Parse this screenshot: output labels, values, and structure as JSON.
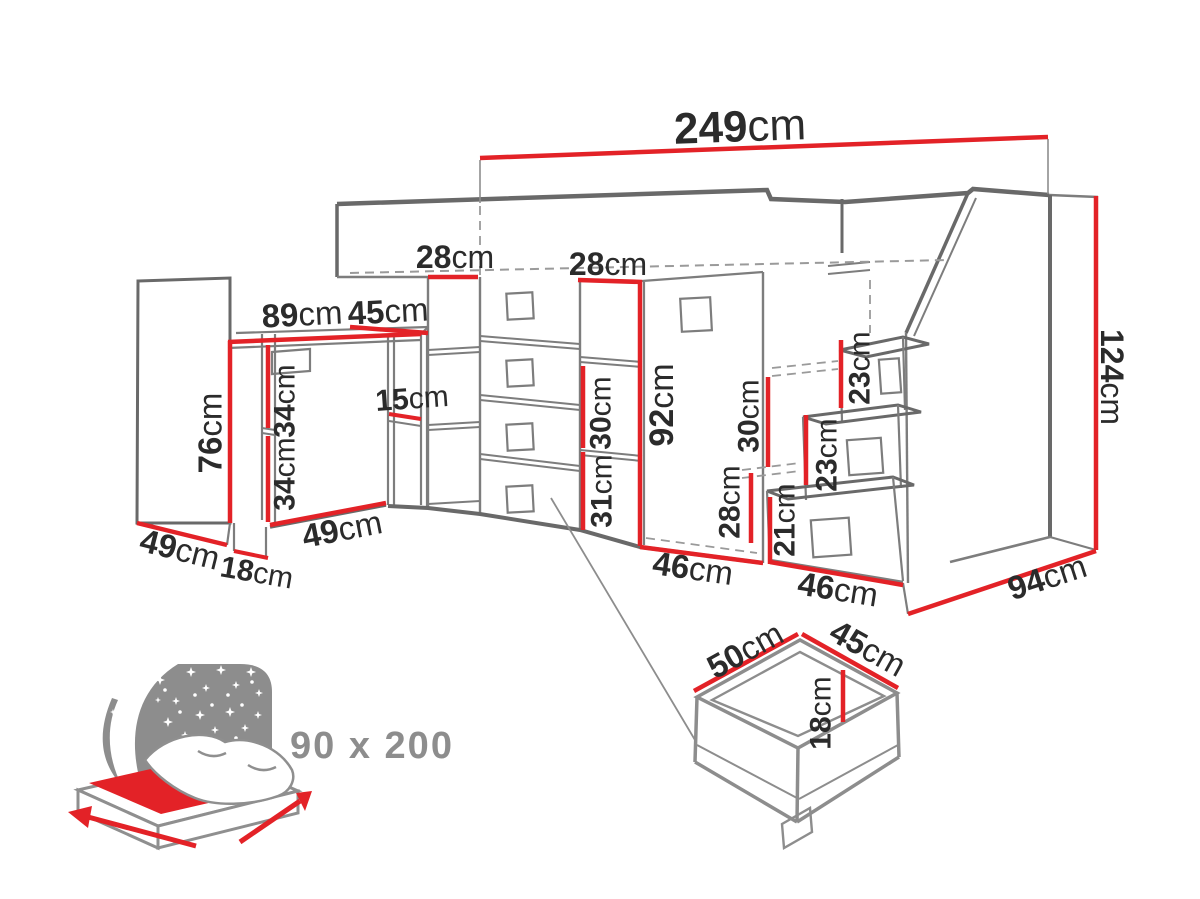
{
  "colors": {
    "dimension_red": "#e32227",
    "line_gray": "#7d7d7d",
    "outline_dark_gray": "#696969",
    "dashed_gray": "#9a9a9a",
    "label_text": "#2b2b2b",
    "icon_gray": "#8d8d8d"
  },
  "unit_default": "cm",
  "dimension_labels": [
    {
      "name": "total-width-249",
      "num": "249",
      "unit": "cm",
      "x": 740,
      "y": 126,
      "rot": -2,
      "size": 44
    },
    {
      "name": "shelf-width-28-left",
      "num": "28",
      "unit": "cm",
      "x": 455,
      "y": 257,
      "rot": 0,
      "size": 32
    },
    {
      "name": "shelf-width-28-right",
      "num": "28",
      "unit": "cm",
      "x": 608,
      "y": 264,
      "rot": 0,
      "size": 32
    },
    {
      "name": "desk-width-89",
      "num": "89",
      "unit": "cm",
      "x": 302,
      "y": 314,
      "rot": -3,
      "size": 33
    },
    {
      "name": "desk-return-45",
      "num": "45",
      "unit": "cm",
      "x": 388,
      "y": 311,
      "rot": -3,
      "size": 33
    },
    {
      "name": "desk-shelf-15",
      "num": "15",
      "unit": "cm",
      "x": 412,
      "y": 398,
      "rot": -4,
      "size": 30
    },
    {
      "name": "desk-height-76",
      "num": "76",
      "unit": "cm",
      "x": 210,
      "y": 433,
      "rot": -90,
      "size": 33
    },
    {
      "name": "under-desk-34-upper",
      "num": "34",
      "unit": "cm",
      "x": 284,
      "y": 401,
      "rot": -90,
      "size": 30
    },
    {
      "name": "under-desk-34-lower",
      "num": "34",
      "unit": "cm",
      "x": 284,
      "y": 474,
      "rot": -90,
      "size": 30
    },
    {
      "name": "wardrobe-depth-49",
      "num": "49",
      "unit": "cm",
      "x": 180,
      "y": 549,
      "rot": 14,
      "size": 33
    },
    {
      "name": "desk-foot-18",
      "num": "18",
      "unit": "cm",
      "x": 257,
      "y": 572,
      "rot": 10,
      "size": 30
    },
    {
      "name": "desk-depth-49",
      "num": "49",
      "unit": "cm",
      "x": 342,
      "y": 529,
      "rot": -11,
      "size": 33
    },
    {
      "name": "shelf-opening-30",
      "num": "30",
      "unit": "cm",
      "x": 600,
      "y": 413,
      "rot": -90,
      "size": 30
    },
    {
      "name": "shelf-opening-31",
      "num": "31",
      "unit": "cm",
      "x": 601,
      "y": 491,
      "rot": -90,
      "size": 30
    },
    {
      "name": "under-bed-height-92",
      "num": "92",
      "unit": "cm",
      "x": 661,
      "y": 405,
      "rot": -90,
      "size": 34
    },
    {
      "name": "cabinet-width-46",
      "num": "46",
      "unit": "cm",
      "x": 693,
      "y": 568,
      "rot": 8,
      "size": 33
    },
    {
      "name": "stairs-opening-30",
      "num": "30",
      "unit": "cm",
      "x": 748,
      "y": 416,
      "rot": -90,
      "size": 30
    },
    {
      "name": "stairs-opening-28",
      "num": "28",
      "unit": "cm",
      "x": 729,
      "y": 502,
      "rot": -90,
      "size": 30
    },
    {
      "name": "step-height-21",
      "num": "21",
      "unit": "cm",
      "x": 784,
      "y": 520,
      "rot": -90,
      "size": 30
    },
    {
      "name": "step-height-23-top",
      "num": "23",
      "unit": "cm",
      "x": 859,
      "y": 368,
      "rot": -90,
      "size": 30
    },
    {
      "name": "step-height-23-mid",
      "num": "23",
      "unit": "cm",
      "x": 826,
      "y": 455,
      "rot": -90,
      "size": 30
    },
    {
      "name": "stairs-width-46",
      "num": "46",
      "unit": "cm",
      "x": 838,
      "y": 589,
      "rot": 9,
      "size": 33
    },
    {
      "name": "depth-94",
      "num": "94",
      "unit": "cm",
      "x": 1047,
      "y": 577,
      "rot": -18,
      "size": 33
    },
    {
      "name": "total-height-124",
      "num": "124",
      "unit": "cm",
      "x": 1112,
      "y": 377,
      "rot": 90,
      "size": 32
    },
    {
      "name": "drawer-depth-50",
      "num": "50",
      "unit": "cm",
      "x": 745,
      "y": 650,
      "rot": -29,
      "size": 33
    },
    {
      "name": "drawer-width-45",
      "num": "45",
      "unit": "cm",
      "x": 868,
      "y": 648,
      "rot": 29,
      "size": 33
    },
    {
      "name": "drawer-height-18",
      "num": "18",
      "unit": "cm",
      "x": 820,
      "y": 713,
      "rot": -90,
      "size": 30
    }
  ],
  "bed_icon": {
    "size_text": "90 x 200"
  }
}
